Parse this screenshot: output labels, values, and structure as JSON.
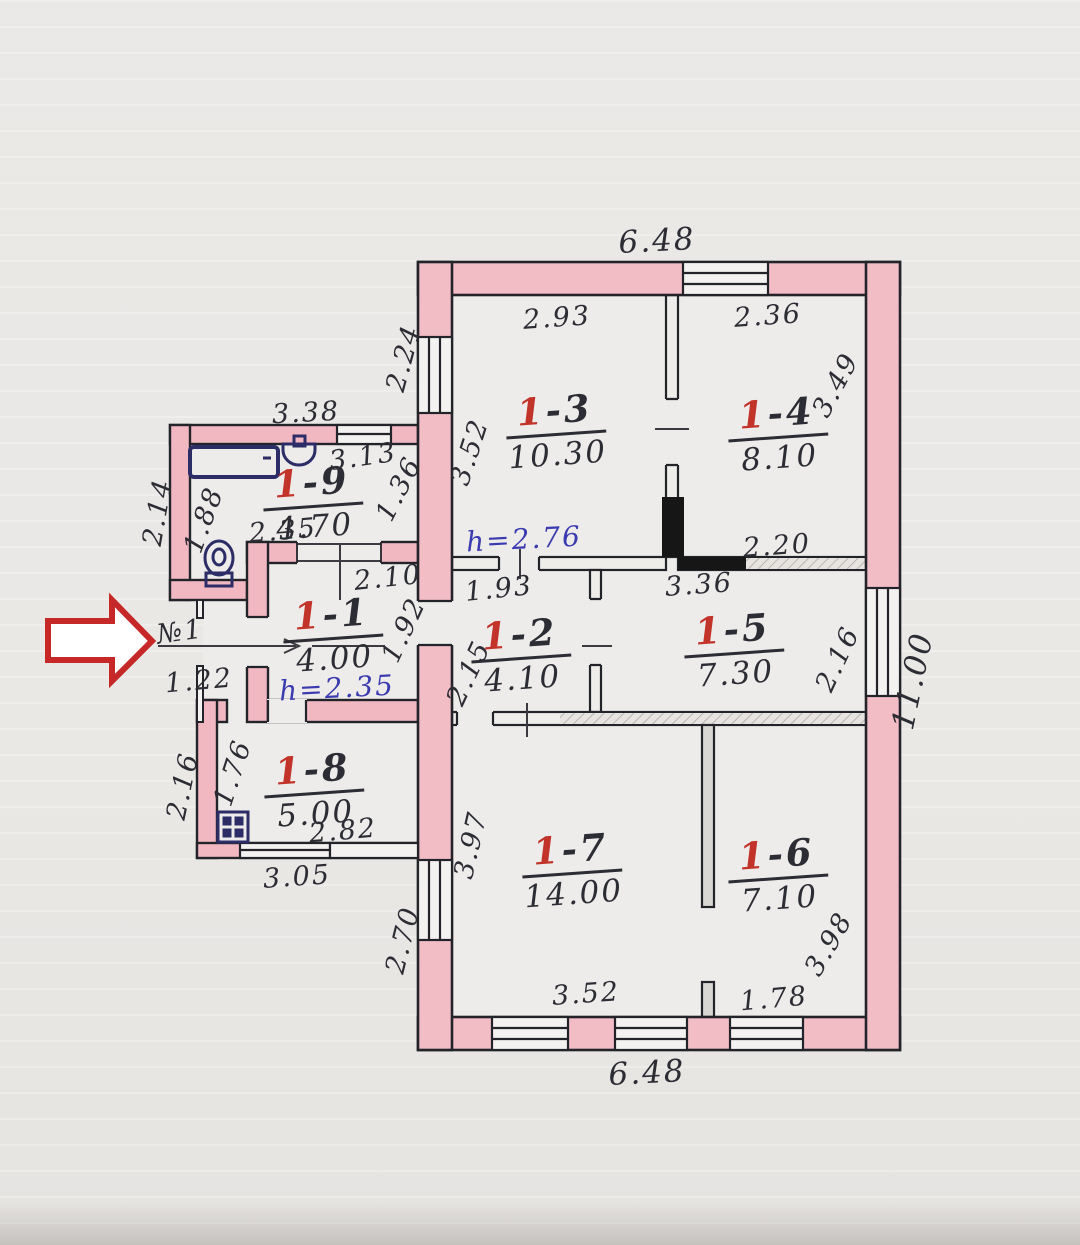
{
  "plan": {
    "entrance": {
      "door_no": "№1",
      "width": "1.22"
    },
    "heights": {
      "upper": "h=2.76",
      "lower": "h=2.35"
    },
    "rooms": {
      "r11": {
        "prefix": "1",
        "suffix": "-1",
        "area": "4.00"
      },
      "r12": {
        "prefix": "1",
        "suffix": "-2",
        "area": "4.10"
      },
      "r13": {
        "prefix": "1",
        "suffix": "-3",
        "area": "10.30"
      },
      "r14": {
        "prefix": "1",
        "suffix": "-4",
        "area": "8.10"
      },
      "r15": {
        "prefix": "1",
        "suffix": "-5",
        "area": "7.30"
      },
      "r16": {
        "prefix": "1",
        "suffix": "-6",
        "area": "7.10"
      },
      "r17": {
        "prefix": "1",
        "suffix": "-7",
        "area": "14.00"
      },
      "r18": {
        "prefix": "1",
        "suffix": "-8",
        "area": "5.00"
      },
      "r19": {
        "prefix": "1",
        "suffix": "-9",
        "area": "4.70"
      }
    },
    "dims": {
      "top_width": "6.48",
      "bottom_width": "6.48",
      "right_height": "11.00",
      "r13_w": "2.93",
      "r13_h": "3.52",
      "r14_w": "2.36",
      "r14_h": "3.49",
      "r14_bottom": "2.20",
      "left_window_top": "2.24",
      "left_window_bottom": "2.70",
      "annex_top": "3.38",
      "annex_inner": "3.13",
      "r19_right": "1.36",
      "annex_left": "2.14",
      "r19_left": "1.88",
      "r19_bottom": "2.35",
      "r11_w": "2.10",
      "r11_h": "1.92",
      "r12_w": "1.93",
      "r12_h": "2.15",
      "r15_w": "3.36",
      "r15_right": "2.16",
      "kitchen_left": "2.16",
      "r18_left": "1.76",
      "r18_bottom": "2.82",
      "kitchen_bottom": "3.05",
      "r17_left": "3.97",
      "r17_bottom": "3.52",
      "r16_right": "3.98",
      "r16_bottom": "1.78"
    }
  }
}
